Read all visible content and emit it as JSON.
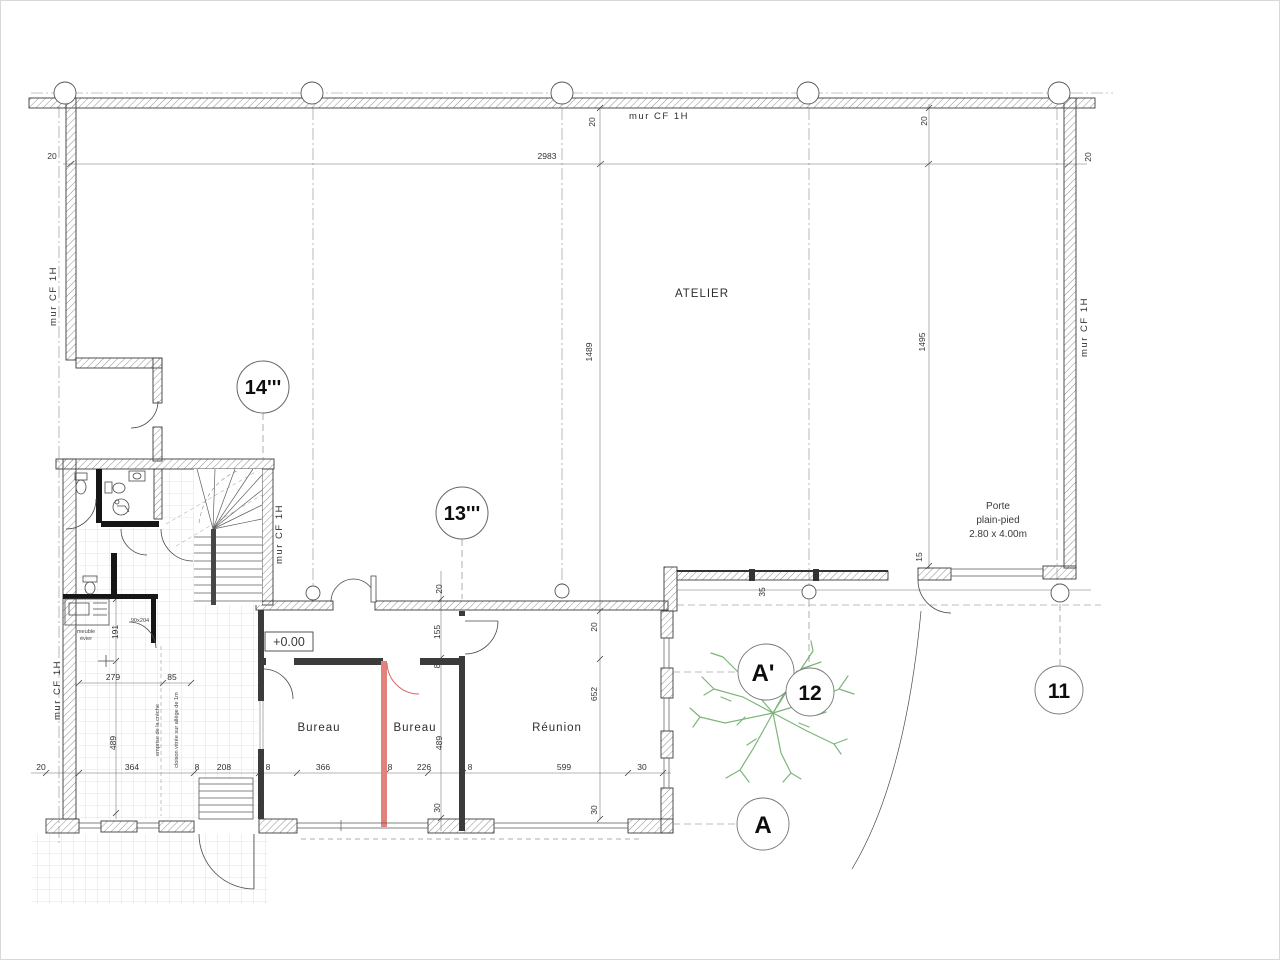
{
  "drawing": {
    "rooms": {
      "atelier": "ATELIER",
      "bureau_left": "Bureau",
      "bureau_right": "Bureau",
      "reunion": "Réunion"
    },
    "wall_label": "mur CF 1H",
    "level_marker": "+0.00",
    "porte_note": {
      "line1": "Porte",
      "line2": "plain-pied",
      "line3": "2.80 x 4.00m"
    },
    "markers": {
      "m14": "14'''",
      "m13": "13'''",
      "m12": "12",
      "m11": "11",
      "a": "A",
      "a_prime": "A'"
    },
    "dims": {
      "top_left_20": "20",
      "span_2983": "2983",
      "wall_20a": "20",
      "wall_20b": "20",
      "right_20": "20",
      "h_1489": "1489",
      "h_1495": "1495",
      "v15": "15",
      "v35": "35",
      "c440_20": "20",
      "c440_155": "155",
      "c440_8": "8",
      "c440_489": "489",
      "c440_30": "30",
      "c597_20": "20",
      "c597_652": "652",
      "c597_30": "30",
      "left_191": "191",
      "left_279": "279",
      "left_85": "85",
      "left_489": "489",
      "b_20": "20",
      "b_364": "364",
      "b_8a": "8",
      "b_208": "208",
      "b_8b": "8",
      "b_366": "366",
      "b_8c": "8",
      "b_226": "226",
      "b_8d": "8",
      "b_599": "599",
      "b_30": "30"
    },
    "notes": {
      "sink_l1": "meuble",
      "sink_l2": "évier",
      "door_size": "90x204",
      "creche": "emprise de la crèche",
      "cloison": "cloison vitrée sur allège de 1m"
    },
    "colors": {
      "red_wall": "#e2837b",
      "red_door": "#d4675f",
      "tree": "#7db57a"
    }
  }
}
